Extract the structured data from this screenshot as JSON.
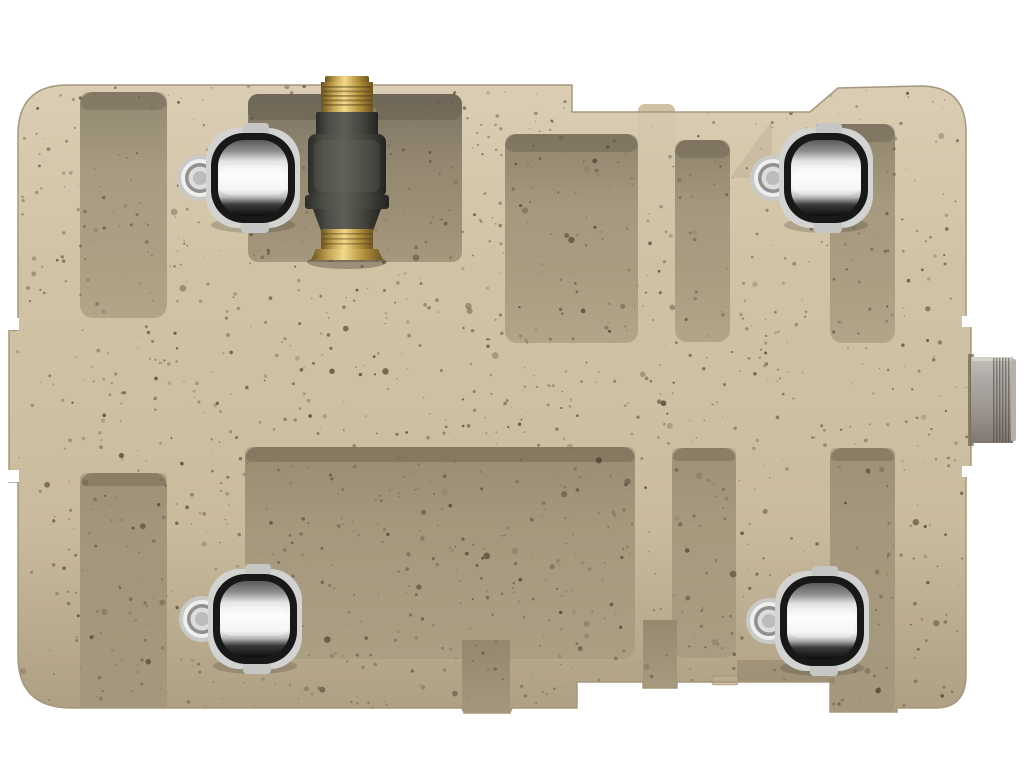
{
  "scene": {
    "description": "Top view 3D product render: tan speckled rotomolded plastic utility tank with molded rib channels, four chrome barrel rollers, a brass inline valve fitting at the top, and a gray threaded outlet pipe on the right side",
    "background_color": "#ffffff"
  },
  "colors": {
    "background": "#ffffff",
    "body_light": "#d4c6a9",
    "body": "#cec0a2",
    "body_dark": "#c2b395",
    "rib": "#cfc1a4",
    "outline": "#a5977b",
    "recess_dark": "#85795f",
    "recess": "#a1947a",
    "recess_light": "#b2a589",
    "pocket_dark": "#6b6150",
    "pocket": "#8b7e66",
    "pocket_light": "#a5977c",
    "recess_bottom_dark": "#9d9076",
    "recess_bottom": "#b6a98d",
    "pocket_bottom_dark": "#998c72",
    "pocket_bottom": "#b8ab8f",
    "chrome_plate": "#d3d3d1",
    "chrome_ring": "#181818",
    "chrome_top": "#5a5a5a",
    "chrome_mid": "#8f8f8f",
    "chrome_white": "#fbfbfa",
    "chrome_shadow": "#3a3a3a",
    "chrome_black": "#0e0e0e",
    "hub_outer": "#c9c9c7",
    "hub_ring_light": "#efefed",
    "hub_ring_dark": "#90908e",
    "hub_face": "#dedddc",
    "hub_center": "#bcbcba",
    "brass_light": "#f0da8c",
    "brass": "#c7a553",
    "brass_dark": "#8a6f2d",
    "brass_deep": "#6b5520",
    "metal_mid": "#5e5e57",
    "metal_dark": "#44443e",
    "metal_deep": "#2b2b27",
    "pipe_light": "#c3bfb8",
    "pipe": "#aeaaa7",
    "pipe_dark": "#9d978f",
    "pipe_deep": "#7e7870"
  },
  "tank": {
    "name": "speckled-tan-tank-body"
  },
  "casters": [
    {
      "name": "caster-top-left",
      "transform": "translate(253,178)"
    },
    {
      "name": "caster-top-right",
      "transform": "translate(826,178)"
    },
    {
      "name": "caster-bottom-left",
      "transform": "translate(255,619)"
    },
    {
      "name": "caster-bottom-right",
      "transform": "translate(822,621)"
    }
  ],
  "valve": {
    "name": "brass-inline-valve-fitting"
  },
  "outlet": {
    "name": "threaded-outlet-pipe"
  },
  "texture": {
    "seed": 987654321,
    "count": 1500,
    "colors": [
      "#6a5c47",
      "#7d7058",
      "#56493a",
      "#8d8069"
    ],
    "region": {
      "x": 8,
      "y": 83,
      "w": 964,
      "h": 633
    }
  }
}
